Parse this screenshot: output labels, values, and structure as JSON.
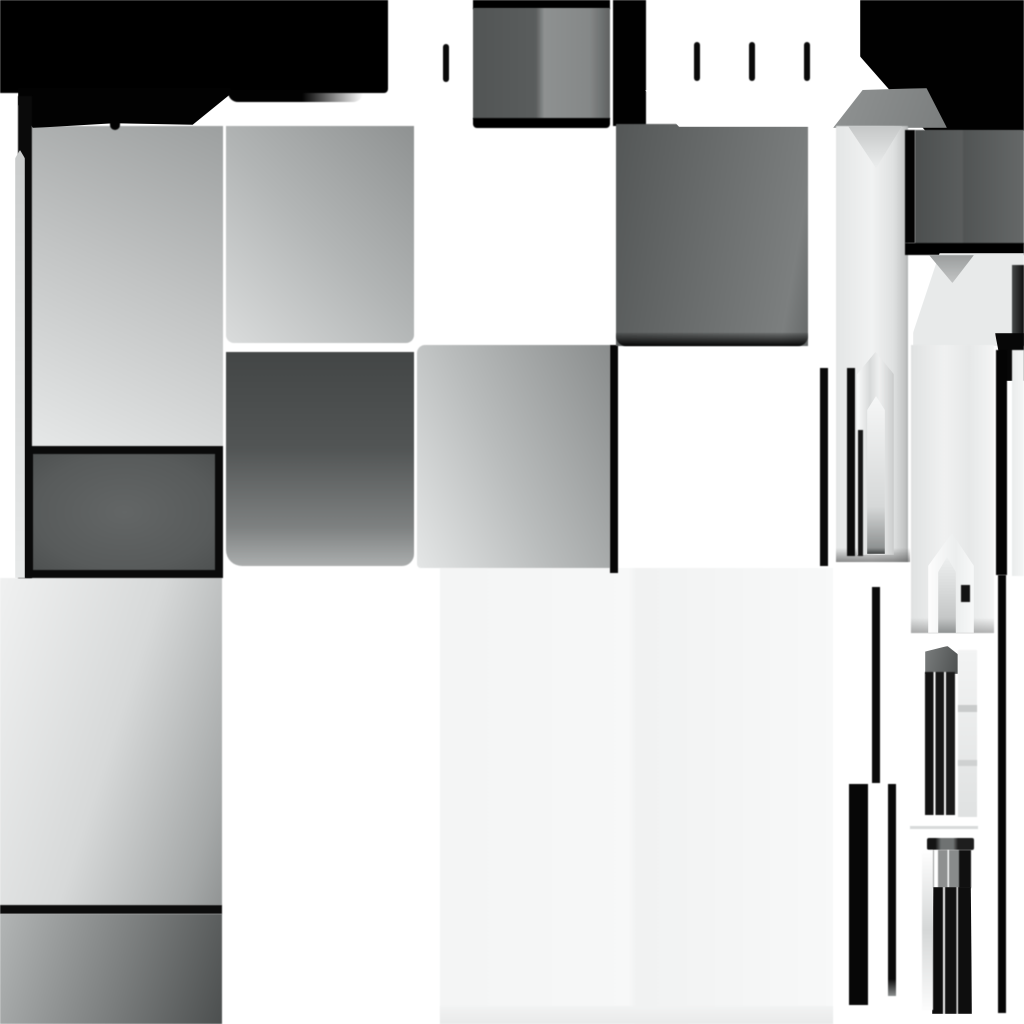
{
  "canvas": {
    "width": 1024,
    "height": 1024,
    "background": "#ffffff"
  },
  "palette": {
    "black": "#000000",
    "near_black": "#0a0a0a",
    "dark_gray": "#4c4f4f",
    "mid_gray": "#6b6e6e",
    "light_gray": "#c2c4c4",
    "pale_gray": "#e6e8e8",
    "off_white": "#f6f7f7",
    "white": "#ffffff"
  },
  "shapes": [
    {
      "name": "bottom-center-pale-panel",
      "x": 440,
      "y": 568,
      "w": 393,
      "h": 456,
      "fill": "linear-gradient(to right,#f4f5f5 0%,#f7f8f8 48%,#f1f2f2 50%,#f8f9f9 100%)"
    },
    {
      "name": "bottom-center-panel-footer",
      "x": 440,
      "y": 1006,
      "w": 393,
      "h": 18,
      "fill": "linear-gradient(to bottom,#f2f3f3,#e9eaea)"
    },
    {
      "name": "left-lower-gradient-tile",
      "x": 0,
      "y": 578,
      "w": 222,
      "h": 327,
      "fill": "linear-gradient(108deg,#f0f1f1 0%,#d7d9d9 50%,#a6a9a9 88%,#919494 100%)"
    },
    {
      "name": "left-lower-black-bar",
      "x": 0,
      "y": 905,
      "w": 222,
      "h": 9,
      "fill": "#0c0c0c"
    },
    {
      "name": "left-bottom-dark-gradient-tile",
      "x": 0,
      "y": 914,
      "w": 222,
      "h": 110,
      "fill": "linear-gradient(108deg,#b2b5b5 0%,#7b7e7e 55%,#4c4f4f 100%)"
    },
    {
      "name": "upper-left-light-tile",
      "x": 32,
      "y": 126,
      "w": 191,
      "h": 320,
      "fill": "linear-gradient(205deg,#9da0a0 0%,#c2c4c4 48%,#e6e8e8 100%)"
    },
    {
      "name": "framed-dark-tile",
      "x": 25,
      "y": 446,
      "w": 198,
      "h": 132,
      "fill": "radial-gradient(ellipse at 50% 50%,#636666 0%,#585b5b 70%,#4e5151 100%)",
      "border": "8px solid #0a0a0a"
    },
    {
      "name": "upper-mid-gray-tile",
      "x": 226,
      "y": 126,
      "w": 188,
      "h": 217,
      "fill": "linear-gradient(225deg,#8f9292 0%,#b2b5b5 50%,#dadcdc 100%)",
      "radius": "0 0 8px 8px"
    },
    {
      "name": "mid-dark-gray-tile",
      "x": 226,
      "y": 352,
      "w": 188,
      "h": 214,
      "fill": "linear-gradient(to bottom,#434646 0%,#525555 45%,#7e8181 82%,#abaeae 100%)",
      "radius": "0 0 12px 16px"
    },
    {
      "name": "center-gray-tile",
      "x": 417,
      "y": 345,
      "w": 193,
      "h": 223,
      "fill": "linear-gradient(245deg,#8a8d8d 0%,#b9bcbc 55%,#e4e6e6 100%)",
      "radius": "8px 0 0 4px"
    },
    {
      "name": "center-tile-right-black-edge",
      "x": 610,
      "y": 345,
      "w": 8,
      "h": 228,
      "fill": "#060606"
    },
    {
      "name": "top-split-tile-top-black",
      "x": 473,
      "y": 0,
      "w": 137,
      "h": 9,
      "fill": "#000000"
    },
    {
      "name": "top-split-gray-tile",
      "x": 473,
      "y": 8,
      "w": 137,
      "h": 111,
      "fill": "linear-gradient(to right,#525555 0%,#5a5d5d 46%,#8e9191 52%,#858888 85%,#5f6262 100%)"
    },
    {
      "name": "top-split-tile-bottom-black",
      "x": 473,
      "y": 118,
      "w": 137,
      "h": 10,
      "fill": "#000000",
      "radius": "0 0 4px 4px"
    },
    {
      "name": "top-left-black-block",
      "x": 0,
      "y": 0,
      "w": 388,
      "h": 93,
      "fill": "#000000",
      "radius": "0 0 4px 0"
    },
    {
      "name": "top-black-lip",
      "x": 228,
      "y": 90,
      "w": 135,
      "h": 12,
      "fill": "linear-gradient(to right,#020202 55%,rgba(2,2,2,0))",
      "radius": "0 0 10px 10px"
    },
    {
      "name": "top-black-tongue",
      "x": 18,
      "y": 88,
      "w": 213,
      "h": 40,
      "fill": "#020202",
      "clip": "polygon(0 0,100% 0,100% 14%,82% 92%,45% 88%,7% 100%,0 42%)"
    },
    {
      "name": "tongue-notch",
      "x": 110,
      "y": 121,
      "w": 10,
      "h": 9,
      "fill": "#020202",
      "radius": "0 0 5px 5px"
    },
    {
      "name": "left-edge-black-strip",
      "x": 18,
      "y": 96,
      "w": 14,
      "h": 482,
      "fill": "#0a0a0a"
    },
    {
      "name": "left-edge-gray-sliver",
      "x": 15,
      "y": 150,
      "w": 10,
      "h": 428,
      "fill": "linear-gradient(to bottom,#c9cbcb,#e7e9e9)",
      "clip": "polygon(50% 0,100% 2%,100% 100%,0 100%,0 2%)"
    },
    {
      "name": "top-connector-black-strip",
      "x": 613,
      "y": 0,
      "w": 33,
      "h": 126,
      "fill": "#010101"
    },
    {
      "name": "upper-right-dark-tile",
      "x": 616,
      "y": 124,
      "w": 192,
      "h": 222,
      "fill": "linear-gradient(100deg,#545757 0%,#6b6e6e 50%,#7c7f7f 88%,#666969 100%)"
    },
    {
      "name": "upper-right-tile-bottom-shadow",
      "x": 616,
      "y": 333,
      "w": 192,
      "h": 13,
      "fill": "linear-gradient(to bottom,rgba(8,8,8,0.15),#060606)",
      "radius": "0 0 10px 10px"
    },
    {
      "name": "white-pocket-extension",
      "x": 645,
      "y": 90,
      "w": 190,
      "h": 37,
      "fill": "#ffffff",
      "clip": "polygon(0 0,100% 0,93% 100%,18% 100%)"
    },
    {
      "name": "top-right-black-block",
      "x": 860,
      "y": 0,
      "w": 164,
      "h": 131,
      "fill": "#010101",
      "clip": "polygon(0 0,100% 0,100% 100%,40% 100%,0 43%)"
    },
    {
      "name": "column1-cap",
      "x": 833,
      "y": 88,
      "w": 114,
      "h": 40,
      "fill": "linear-gradient(110deg,#909393,#7b7e7e)",
      "clip": "polygon(26% 5%,82% 0,100% 100%,0 100%)"
    },
    {
      "name": "column1-shaft",
      "x": 836,
      "y": 126,
      "w": 72,
      "h": 436,
      "fill": "linear-gradient(to right,#e4e6e6 0%,#f1f2f2 50%,#dfe1e1 80%,#c1c3c3 96%,#afb2b2 100%)"
    },
    {
      "name": "column1-v-notch",
      "x": 848,
      "y": 126,
      "w": 54,
      "h": 42,
      "fill": "linear-gradient(to bottom,#c5c7c7,#eceeee)",
      "clip": "polygon(0 0,100% 0,52% 100%)"
    },
    {
      "name": "column1-bottom-shadow",
      "x": 836,
      "y": 548,
      "w": 74,
      "h": 14,
      "fill": "linear-gradient(to bottom,rgba(80,80,80,0),rgba(60,60,60,0.55))"
    },
    {
      "name": "lancet-window-black-line",
      "x": 847,
      "y": 368,
      "w": 8,
      "h": 188,
      "fill": "#0b0b0b"
    },
    {
      "name": "lancet-window-arch",
      "x": 857,
      "y": 352,
      "w": 37,
      "h": 203,
      "fill": "linear-gradient(to right,#fbfcfc 0%,#d7d9d9 35%,#eff0f0 60%,#c9cbcb 100%)",
      "clip": "polygon(50% 0,100% 11%,100% 100%,0 100%,0 11%)"
    },
    {
      "name": "lancet-window-inner-line",
      "x": 858,
      "y": 430,
      "w": 5,
      "h": 126,
      "fill": "#161616"
    },
    {
      "name": "lancet-window-inner-shaft",
      "x": 867,
      "y": 396,
      "w": 18,
      "h": 158,
      "fill": "linear-gradient(to bottom,#f6f7f7 0%,#d6d8d8 70%,#8f9292 96%,#3c3f3f 100%)",
      "clip": "polygon(50% 0,100% 9%,100% 100%,0 100%,0 9%)"
    },
    {
      "name": "thin-bar-left-of-arch",
      "x": 820,
      "y": 368,
      "w": 8,
      "h": 198,
      "fill": "#090909"
    },
    {
      "name": "dark-square-left-black-edge",
      "x": 905,
      "y": 130,
      "w": 10,
      "h": 113,
      "fill": "#030303"
    },
    {
      "name": "right-dark-square-tile",
      "x": 915,
      "y": 130,
      "w": 109,
      "h": 114,
      "fill": "linear-gradient(to right,#4c4f4f 0%,#5a5d5d 43%,#515454 45%,#656868 100%)"
    },
    {
      "name": "dark-square-under-black-strip",
      "x": 905,
      "y": 243,
      "w": 119,
      "h": 12,
      "fill": "#000000"
    },
    {
      "name": "column2-wide-top",
      "x": 913,
      "y": 253,
      "w": 111,
      "h": 93,
      "fill": "#e8eaea",
      "clip": "polygon(24% 0,100% 0,100% 100%,0 100%,0 86%)"
    },
    {
      "name": "column2-v-notch",
      "x": 929,
      "y": 255,
      "w": 45,
      "h": 28,
      "fill": "linear-gradient(to bottom,#9a9d9d,#c3c5c5)",
      "clip": "polygon(0 0,100% 0,52% 100%)"
    },
    {
      "name": "column2-right-dark-edge",
      "x": 1012,
      "y": 265,
      "w": 12,
      "h": 81,
      "fill": "linear-gradient(to right,#454848,#0f0f0f)"
    },
    {
      "name": "column2-corner-black",
      "x": 995,
      "y": 333,
      "w": 29,
      "h": 48,
      "fill": "#070707",
      "clip": "polygon(0 0,100% 0,100% 100%,32% 100%)"
    },
    {
      "name": "column2-shaft",
      "x": 911,
      "y": 345,
      "w": 83,
      "h": 288,
      "fill": "linear-gradient(to right,#e0e2e2 0%,#f0f1f1 40%,#e6e8e8 70%,#f4f5f5 100%)"
    },
    {
      "name": "column2-shaft-bottom-shadow",
      "x": 911,
      "y": 618,
      "w": 83,
      "h": 15,
      "fill": "linear-gradient(to bottom,rgba(120,120,120,0),rgba(110,110,110,0.5))"
    },
    {
      "name": "small-arch-outer",
      "x": 928,
      "y": 533,
      "w": 46,
      "h": 100,
      "fill": "linear-gradient(to right,#fdfdfd,#eceeee 60%,#f8f9f9)",
      "clip": "polygon(52% 0,100% 33%,100% 100%,0 100%,0 33%)"
    },
    {
      "name": "small-arch-inner-shaft",
      "x": 938,
      "y": 557,
      "w": 18,
      "h": 76,
      "fill": "linear-gradient(to bottom,#eef0f0,#c5c7c7 80%,#8e9191)",
      "clip": "polygon(50% 0,100% 20%,100% 100%,0 100%,0 20%)"
    },
    {
      "name": "small-arch-black-notch",
      "x": 961,
      "y": 585,
      "w": 9,
      "h": 17,
      "fill": "#131313"
    },
    {
      "name": "right-edge-light-strip",
      "x": 1012,
      "y": 350,
      "w": 12,
      "h": 226,
      "fill": "linear-gradient(to right,#eaecec,#f5f6f6)"
    },
    {
      "name": "right-black-bar-upper",
      "x": 996,
      "y": 350,
      "w": 11,
      "h": 225,
      "fill": "#040404"
    },
    {
      "name": "right-black-bar-lower",
      "x": 998,
      "y": 575,
      "w": 8,
      "h": 438,
      "fill": "#060606"
    },
    {
      "name": "thin-black-bar-middle",
      "x": 872,
      "y": 587,
      "w": 8,
      "h": 196,
      "fill": "#0a0a0a"
    },
    {
      "name": "thick-black-bar-lower-left",
      "x": 849,
      "y": 784,
      "w": 19,
      "h": 221,
      "fill": "#070707"
    },
    {
      "name": "thin-black-bar-lower-right",
      "x": 888,
      "y": 784,
      "w": 8,
      "h": 212,
      "fill": "linear-gradient(to bottom,#0a0a0a 92%,#8b8e8e)"
    },
    {
      "name": "cluster1-cap",
      "x": 925,
      "y": 646,
      "w": 33,
      "h": 28,
      "fill": "linear-gradient(105deg,#7a7d7d,#4e5151)",
      "clip": "polygon(0 20%,68% 0,100% 30%,100% 100%,0 100%)"
    },
    {
      "name": "cluster1-black-shafts",
      "x": 925,
      "y": 672,
      "w": 30,
      "h": 143,
      "fill": "linear-gradient(to right,#121212 0 29%,#fafafa 29% 35%,#161616 35% 64%,#f8f8f8 64% 70%,#1a1a1a 70% 100%)"
    },
    {
      "name": "cluster1-right-light-strip",
      "x": 958,
      "y": 650,
      "w": 19,
      "h": 167,
      "fill": "linear-gradient(to bottom,#f3f4f4,#e0e2e2)"
    },
    {
      "name": "cluster1-strip-segment-1",
      "x": 958,
      "y": 705,
      "w": 19,
      "h": 7,
      "fill": "#c9cbcb"
    },
    {
      "name": "cluster1-strip-segment-2",
      "x": 958,
      "y": 760,
      "w": 19,
      "h": 6,
      "fill": "#cfd1d1"
    },
    {
      "name": "cluster-divider-line",
      "x": 910,
      "y": 826,
      "w": 68,
      "h": 3,
      "fill": "#d8dada"
    },
    {
      "name": "cluster2-cap",
      "x": 927,
      "y": 838,
      "w": 47,
      "h": 12,
      "fill": "linear-gradient(to right,#141414 0 18%,#6f7272 30% 56%,#1e1e1e 66% 100%)",
      "radius": "2px"
    },
    {
      "name": "cluster2-mid-stripes",
      "x": 929,
      "y": 850,
      "w": 42,
      "h": 38,
      "fill": "linear-gradient(to right,#9c9e9e 0 12%,#ffffff 12% 21%,#8e9090 21% 44%,#fbfbfb 44% 48%,#888b8b 48% 72%,#101010 72% 100%)"
    },
    {
      "name": "cluster2-black-shafts",
      "x": 932,
      "y": 887,
      "w": 40,
      "h": 127,
      "fill": "linear-gradient(to right,#0d0d0d 0 28%,#f4f4f4 28% 33%,#111111 33% 61%,#ededed 61% 65%,#0e0e0e 65% 100%)",
      "clip": "polygon(3% 0,97% 0,100% 100%,0 100%)"
    },
    {
      "name": "cluster2-left-fade-strip",
      "x": 922,
      "y": 850,
      "w": 11,
      "h": 160,
      "fill": "linear-gradient(to bottom,#ffffff,#d5d7d7 50%,#fdfdfd)"
    },
    {
      "name": "tick-mark-1",
      "x": 443,
      "y": 44,
      "w": 6,
      "h": 38,
      "fill": "#0a0a0a",
      "radius": "3px"
    },
    {
      "name": "tick-mark-2",
      "x": 694,
      "y": 42,
      "w": 6,
      "h": 39,
      "fill": "#0a0a0a",
      "radius": "3px"
    },
    {
      "name": "tick-mark-3",
      "x": 749,
      "y": 42,
      "w": 6,
      "h": 39,
      "fill": "#0a0a0a",
      "radius": "3px"
    },
    {
      "name": "tick-mark-4",
      "x": 804,
      "y": 42,
      "w": 6,
      "h": 39,
      "fill": "#0a0a0a",
      "radius": "3px"
    }
  ]
}
